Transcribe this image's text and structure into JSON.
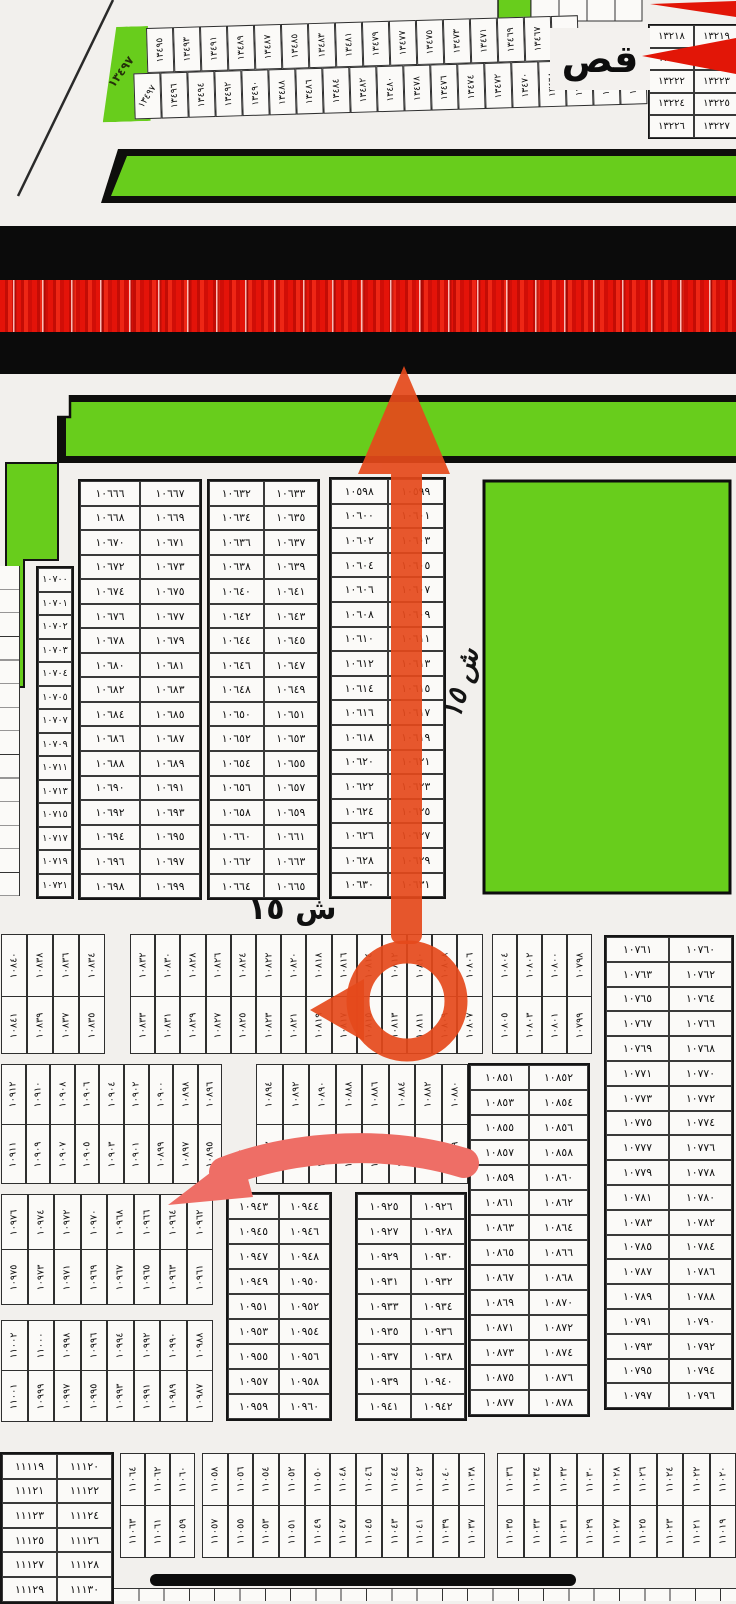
{
  "labels": {
    "erase_patch": "قص",
    "street_15": "ش ١٥",
    "street_15_vertical": "ش ١٥",
    "wedge_handwritten": "١٣٤٩٧"
  },
  "colors": {
    "park_green": "#68cd1c",
    "road_black": "#0b0b0b",
    "road_red": "#dd1008",
    "annotation_red": "#e5491b",
    "annotation_pink": "#ee6e66",
    "paper": "#f2f0ed",
    "ink": "#151515"
  },
  "top_strip": {
    "row1": [
      13495,
      13493,
      13491,
      13489,
      13487,
      13485,
      13483,
      13481,
      13479,
      13477,
      13475,
      13473,
      13471,
      13469,
      13467
    ],
    "row2": [
      13497,
      13496,
      13494,
      13492,
      13490,
      13488,
      13486,
      13484,
      13482,
      13480,
      13478,
      13476,
      13474,
      13472,
      13470,
      13468,
      13466,
      13464,
      13462
    ]
  },
  "top_right_table": {
    "rows": [
      [
        13218,
        13219
      ],
      [
        13220,
        13221
      ],
      [
        13222,
        13223
      ],
      [
        13224,
        13225
      ],
      [
        13226,
        13227
      ]
    ]
  },
  "mid": {
    "col_left": [
      10700,
      10701,
      10702,
      10703,
      10704,
      10705,
      10707,
      10709,
      10711,
      10713,
      10715,
      10717,
      10719,
      10721
    ],
    "table_a": {
      "rows": [
        [
          10666,
          10667
        ],
        [
          10668,
          10669
        ],
        [
          10670,
          10671
        ],
        [
          10672,
          10673
        ],
        [
          10674,
          10675
        ],
        [
          10676,
          10677
        ],
        [
          10678,
          10679
        ],
        [
          10680,
          10681
        ],
        [
          10682,
          10683
        ],
        [
          10684,
          10685
        ],
        [
          10686,
          10687
        ],
        [
          10688,
          10689
        ],
        [
          10690,
          10691
        ],
        [
          10692,
          10693
        ],
        [
          10694,
          10695
        ],
        [
          10696,
          10697
        ],
        [
          10698,
          10699
        ]
      ]
    },
    "table_b": {
      "rows": [
        [
          10632,
          10633
        ],
        [
          10634,
          10635
        ],
        [
          10636,
          10637
        ],
        [
          10638,
          10639
        ],
        [
          10640,
          10641
        ],
        [
          10642,
          10643
        ],
        [
          10644,
          10645
        ],
        [
          10646,
          10647
        ],
        [
          10648,
          10649
        ],
        [
          10650,
          10651
        ],
        [
          10652,
          10653
        ],
        [
          10654,
          10655
        ],
        [
          10656,
          10657
        ],
        [
          10658,
          10659
        ],
        [
          10660,
          10661
        ],
        [
          10662,
          10663
        ],
        [
          10664,
          10665
        ]
      ]
    },
    "table_c": {
      "rows": [
        [
          10598,
          10599
        ],
        [
          10600,
          10601
        ],
        [
          10602,
          10603
        ],
        [
          10604,
          10605
        ],
        [
          10606,
          10607
        ],
        [
          10608,
          10609
        ],
        [
          10610,
          10611
        ],
        [
          10612,
          10613
        ],
        [
          10614,
          10615
        ],
        [
          10616,
          10617
        ],
        [
          10618,
          10619
        ],
        [
          10620,
          10621
        ],
        [
          10622,
          10623
        ],
        [
          10624,
          10625
        ],
        [
          10626,
          10627
        ],
        [
          10628,
          10629
        ],
        [
          10630,
          10631
        ]
      ]
    }
  },
  "band1": {
    "block1": [
      [
        10840,
        10841
      ],
      [
        10838,
        10839
      ],
      [
        10836,
        10837
      ],
      [
        10834,
        10835
      ]
    ],
    "block2": [
      [
        10832,
        10833
      ],
      [
        10830,
        10831
      ],
      [
        10828,
        10829
      ],
      [
        10826,
        10827
      ],
      [
        10824,
        10825
      ],
      [
        10822,
        10823
      ],
      [
        10820,
        10821
      ],
      [
        10818,
        10819
      ],
      [
        10816,
        10817
      ],
      [
        10814,
        10815
      ],
      [
        10812,
        10813
      ],
      [
        10810,
        10811
      ],
      [
        10808,
        10809
      ],
      [
        10806,
        10807
      ]
    ],
    "block3": [
      [
        10804,
        10805
      ],
      [
        10802,
        10803
      ],
      [
        10800,
        10801
      ],
      [
        10798,
        10799
      ]
    ]
  },
  "right_table": {
    "rows": [
      [
        10761,
        10760
      ],
      [
        10763,
        10762
      ],
      [
        10765,
        10764
      ],
      [
        10767,
        10766
      ],
      [
        10769,
        10768
      ],
      [
        10771,
        10770
      ],
      [
        10773,
        10772
      ],
      [
        10775,
        10774
      ],
      [
        10777,
        10776
      ],
      [
        10779,
        10778
      ],
      [
        10781,
        10780
      ],
      [
        10783,
        10782
      ],
      [
        10785,
        10784
      ],
      [
        10787,
        10786
      ],
      [
        10789,
        10788
      ],
      [
        10791,
        10790
      ],
      [
        10793,
        10792
      ],
      [
        10795,
        10794
      ],
      [
        10797,
        10796
      ]
    ]
  },
  "band2": {
    "block1": [
      [
        10912,
        10911
      ],
      [
        10910,
        10909
      ],
      [
        10908,
        10907
      ],
      [
        10906,
        10905
      ],
      [
        10904,
        10903
      ],
      [
        10902,
        10901
      ],
      [
        10900,
        10899
      ],
      [
        10898,
        10897
      ],
      [
        10896,
        10895
      ]
    ],
    "block2": [
      [
        10894,
        10893
      ],
      [
        10892,
        10891
      ],
      [
        10890,
        10889
      ],
      [
        10888,
        10887
      ],
      [
        10886,
        10885
      ],
      [
        10884,
        10883
      ],
      [
        10882,
        10881
      ],
      [
        10880,
        10879
      ]
    ]
  },
  "mid_right_table": {
    "rows": [
      [
        10851,
        10852
      ],
      [
        10853,
        10854
      ],
      [
        10855,
        10856
      ],
      [
        10857,
        10858
      ],
      [
        10859,
        10860
      ],
      [
        10861,
        10862
      ],
      [
        10863,
        10864
      ],
      [
        10865,
        10866
      ],
      [
        10867,
        10868
      ],
      [
        10869,
        10870
      ],
      [
        10871,
        10872
      ],
      [
        10873,
        10874
      ],
      [
        10875,
        10876
      ],
      [
        10877,
        10878
      ]
    ]
  },
  "band3": [
    [
      10976,
      10975
    ],
    [
      10974,
      10973
    ],
    [
      10972,
      10971
    ],
    [
      10970,
      10969
    ],
    [
      10968,
      10967
    ],
    [
      10966,
      10965
    ],
    [
      10964,
      10963
    ],
    [
      10962,
      10961
    ]
  ],
  "band4": [
    [
      11002,
      11001
    ],
    [
      11000,
      10999
    ],
    [
      10998,
      10997
    ],
    [
      10996,
      10995
    ],
    [
      10994,
      10993
    ],
    [
      10992,
      10991
    ],
    [
      10990,
      10989
    ],
    [
      10988,
      10987
    ]
  ],
  "table_d": {
    "rows": [
      [
        10943,
        10944
      ],
      [
        10945,
        10946
      ],
      [
        10947,
        10948
      ],
      [
        10949,
        10950
      ],
      [
        10951,
        10952
      ],
      [
        10953,
        10954
      ],
      [
        10955,
        10956
      ],
      [
        10957,
        10958
      ],
      [
        10959,
        10960
      ]
    ]
  },
  "table_e": {
    "rows": [
      [
        10925,
        10926
      ],
      [
        10927,
        10928
      ],
      [
        10929,
        10930
      ],
      [
        10931,
        10932
      ],
      [
        10933,
        10934
      ],
      [
        10935,
        10936
      ],
      [
        10937,
        10938
      ],
      [
        10939,
        10940
      ],
      [
        10941,
        10942
      ]
    ]
  },
  "band5": {
    "block_a": [
      [
        11064,
        11063
      ],
      [
        11062,
        11061
      ],
      [
        11060,
        11059
      ]
    ],
    "block_b": [
      [
        11058,
        11057
      ],
      [
        11056,
        11055
      ],
      [
        11054,
        11053
      ],
      [
        11052,
        11051
      ],
      [
        11050,
        11049
      ],
      [
        11048,
        11047
      ],
      [
        11046,
        11045
      ],
      [
        11044,
        11043
      ],
      [
        11042,
        11041
      ],
      [
        11040,
        11039
      ],
      [
        11038,
        11037
      ]
    ],
    "block_c": [
      [
        11036,
        11035
      ],
      [
        11034,
        11033
      ],
      [
        11032,
        11031
      ],
      [
        11030,
        11029
      ],
      [
        11028,
        11027
      ],
      [
        11026,
        11025
      ],
      [
        11024,
        11023
      ],
      [
        11022,
        11021
      ],
      [
        11020,
        11019
      ]
    ]
  },
  "bottom_left_table": {
    "rows": [
      [
        11119,
        11120
      ],
      [
        11121,
        11122
      ],
      [
        11123,
        11124
      ],
      [
        11125,
        11126
      ],
      [
        11127,
        11128
      ],
      [
        11129,
        11130
      ]
    ]
  }
}
